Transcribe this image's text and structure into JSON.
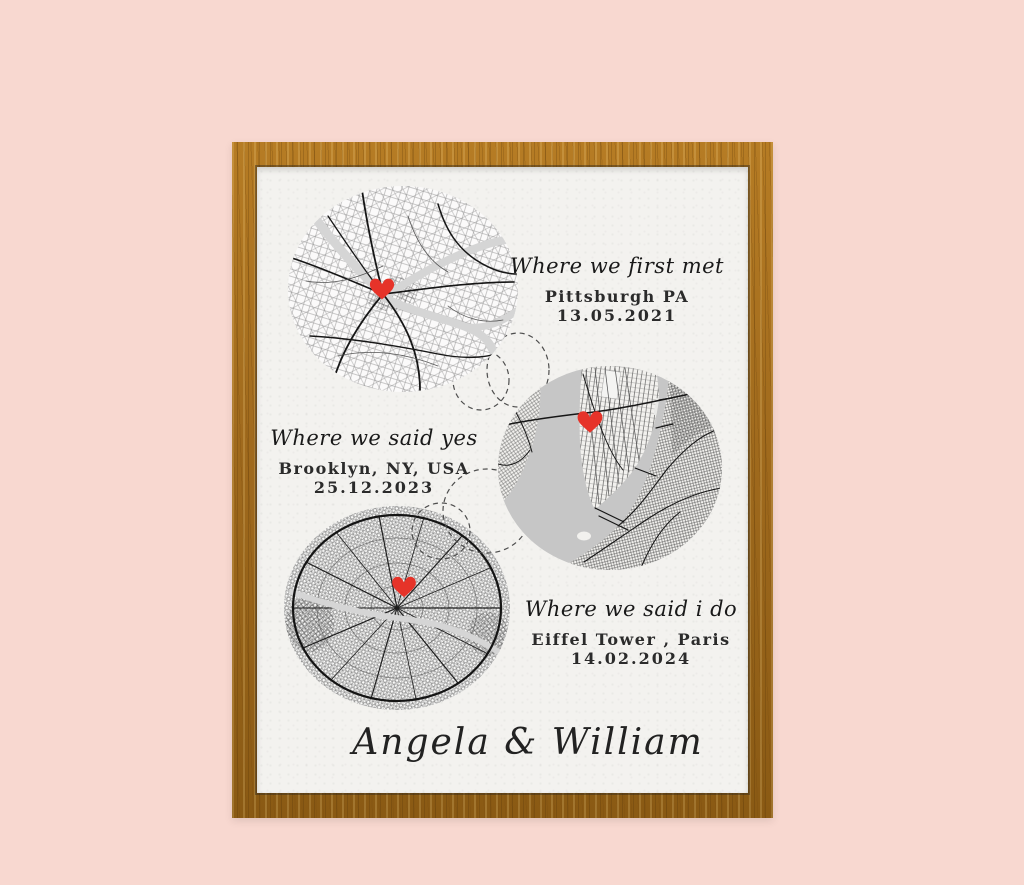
{
  "theme": {
    "pink_bg": "#f8d8d0",
    "wood_base": "#a06a1d",
    "wood_light": "#b67c24",
    "wood_dark": "#8a5a14",
    "paper": "#f3f2ef",
    "map_ink": "#161616",
    "water_gray": "#c6c6c6",
    "accent_red": "#e63329"
  },
  "poster": {
    "locations": [
      {
        "caption": "Where we first met",
        "place": "Pittsburgh PA",
        "date": "13.05.2021",
        "map_name": "pittsburgh-map",
        "marker_icon": "red-heart"
      },
      {
        "caption": "Where we said yes",
        "place": "Brooklyn, NY, USA",
        "date": "25.12.2023",
        "map_name": "new-york-map",
        "marker_icon": "red-heart"
      },
      {
        "caption": "Where we said i do",
        "place": "Eiffel Tower , Paris",
        "date": "14.02.2024",
        "map_name": "paris-map",
        "marker_icon": "red-heart"
      }
    ],
    "signature": "Angela & William"
  }
}
